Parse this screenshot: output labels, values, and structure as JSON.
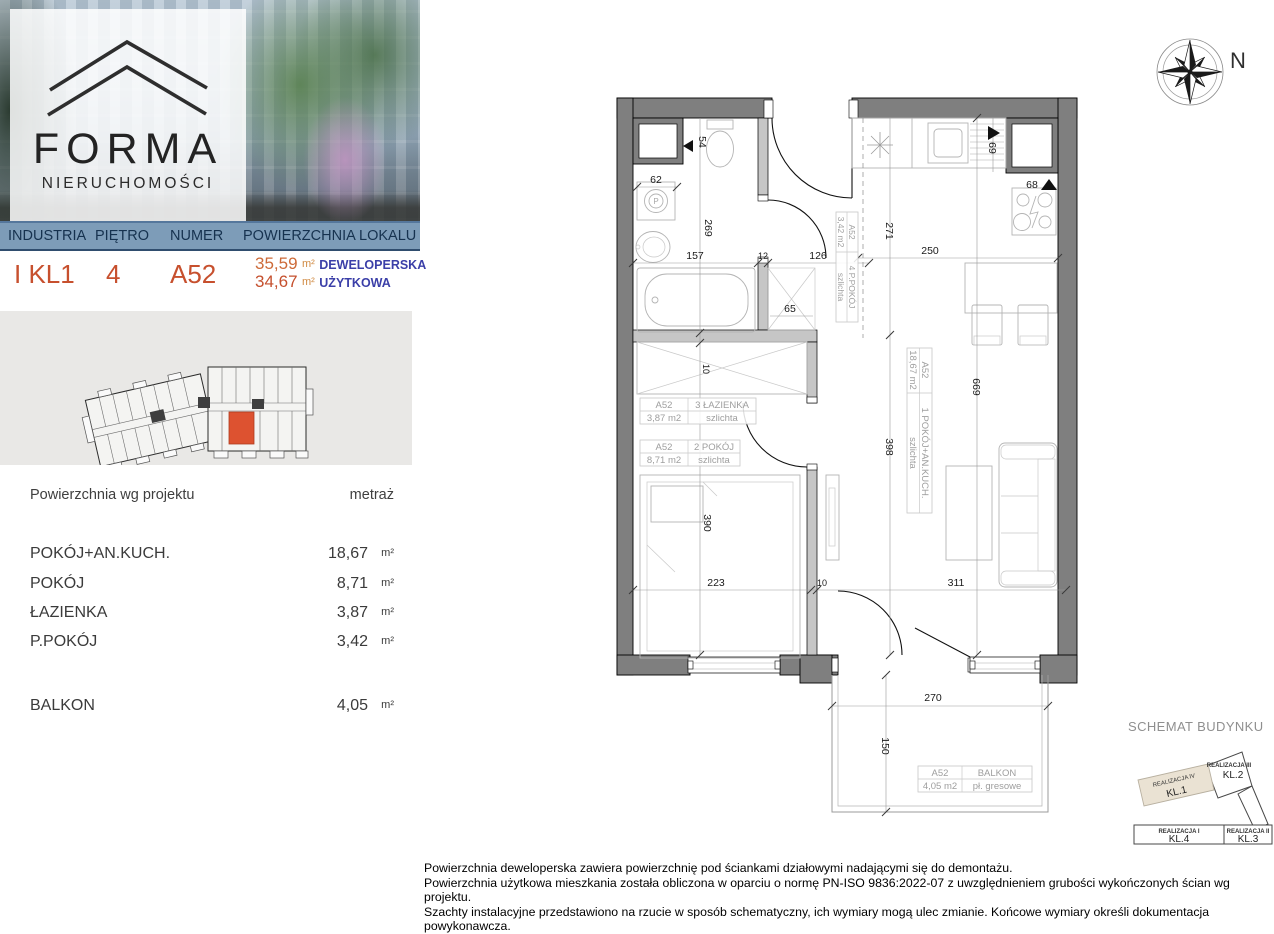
{
  "brand": {
    "name": "FORMA",
    "subtitle": "NIERUCHOMOŚCI"
  },
  "header": {
    "columns": [
      "INDUSTRIA",
      "PIĘTRO",
      "NUMER",
      "POWIERZCHNIA LOKALU"
    ],
    "investment": "I KL1",
    "floor": "4",
    "unit_number": "A52",
    "area_developer": "35,59",
    "area_developer_unit": "m²",
    "area_developer_label": "DEWELOPERSKA",
    "area_usable": "34,67",
    "area_usable_unit": "m²",
    "area_usable_label": "UŻYTKOWA"
  },
  "area_table": {
    "header_name": "Powierzchnia wg projektu",
    "header_value": "metraż",
    "unit": "m²",
    "rows": [
      {
        "name": "POKÓJ+AN.KUCH.",
        "value": "18,67"
      },
      {
        "name": "POKÓJ",
        "value": "8,71"
      },
      {
        "name": "ŁAZIENKA",
        "value": "3,87"
      },
      {
        "name": "P.POKÓJ",
        "value": "3,42"
      }
    ],
    "balcony": {
      "name": "BALKON",
      "value": "4,05"
    }
  },
  "compass": {
    "north": "N"
  },
  "plan": {
    "dims": {
      "d54": "54",
      "d62": "62",
      "d269": "269",
      "d157": "157",
      "d12": "12",
      "d126": "126",
      "d65": "65",
      "d69": "69",
      "d68": "68",
      "d271": "271",
      "d250": "250",
      "d669": "669",
      "d398": "398",
      "d10_top": "10",
      "d390": "390",
      "d223": "223",
      "d10_bottom": "10",
      "d311": "311",
      "d270": "270",
      "d150": "150"
    },
    "labels": {
      "hall": {
        "code": "A52",
        "name": "4 P.POKÓJ",
        "area": "3,42 m2",
        "floor": "szlichta"
      },
      "living": {
        "code": "A52",
        "name": "1 POKÓJ+AN.KUCH.",
        "area": "18,67 m2",
        "floor": "szlichta"
      },
      "bath": {
        "code": "A52",
        "name": "3 ŁAZIENKA",
        "area": "3,87 m2",
        "floor": "szlichta"
      },
      "bedroom": {
        "code": "A52",
        "name": "2 POKÓJ",
        "area": "8,71 m2",
        "floor": "szlichta"
      },
      "balcony": {
        "code": "A52",
        "name": "BALKON",
        "area": "4,05 m2",
        "floor": "pł. gresowe"
      },
      "washer_symbol": "P"
    }
  },
  "schemat": {
    "title": "SCHEMAT BUDYNKU",
    "blocks": [
      {
        "realization": "REALIZACJA IV",
        "kl": "KL.1"
      },
      {
        "realization": "REALIZACJA III",
        "kl": "KL.2"
      },
      {
        "realization": "REALIZACJA II",
        "kl": "KL.3"
      },
      {
        "realization": "REALIZACJA I",
        "kl": "KL.4"
      }
    ]
  },
  "footnotes": [
    "Powierzchnia deweloperska zawiera powierzchnię pod ściankami działowymi nadającymi się do demontażu.",
    "Powierzchnia użytkowa mieszkania została obliczona w oparciu o normę  PN-ISO 9836:2022-07 z uwzględnieniem grubości wykończonych ścian wg projektu.",
    "Szachty instalacyjne przedstawiono na rzucie w sposób schematyczny, ich wymiary mogą ulec zmianie. Końcowe wymiary określi dokumentacja powykonawcza."
  ],
  "colors": {
    "band_background": "#7d9cb8",
    "band_text": "#16324f",
    "accent_red_orange": "#c7502e",
    "accent_orange": "#cd6a38",
    "label_blue": "#3b3fa8",
    "highlighted_unit": "#dd5230",
    "schemat_highlight_beige": "#eae2d3",
    "wall_gray": "#7f7f7f"
  }
}
